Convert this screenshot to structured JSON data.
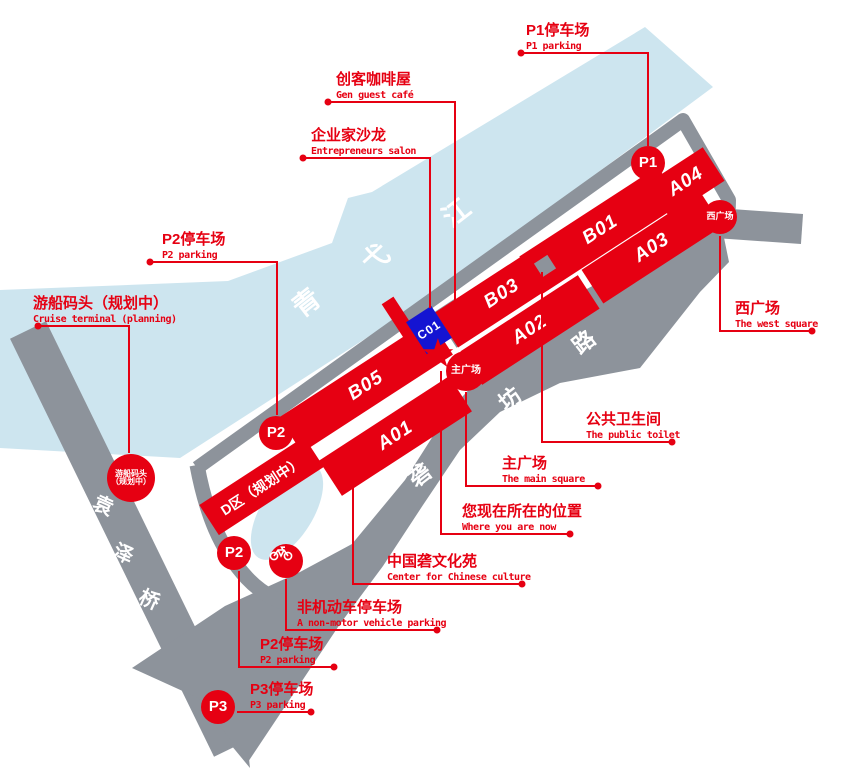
{
  "colors": {
    "accent_red": "#e60012",
    "river_blue": "#cde5ef",
    "road_gray": "#8d939b",
    "c01_blue": "#1414d2"
  },
  "geo_chars": {
    "river": [
      "青",
      "弋",
      "江"
    ],
    "bridge": [
      "袁",
      "泽",
      "桥"
    ],
    "road": [
      "砻",
      "坊",
      "路"
    ]
  },
  "buildings": {
    "b01": "B01",
    "b03": "B03",
    "a01": "A01",
    "a02": "A02",
    "a03": "A03",
    "a04": "A04",
    "b05": "B05",
    "c01": "C01",
    "d_zone": "D区（规划中）"
  },
  "markers": {
    "p1": "P1",
    "p2": "P2",
    "p3": "P3",
    "west_square": "西广场",
    "main_square": "主广场",
    "cruise_line1": "游船码头",
    "cruise_line2": "（规划中）",
    "star": "★"
  },
  "labels": {
    "p1_parking": {
      "zh": "P1停车场",
      "en": "P1 parking"
    },
    "maker_cafe": {
      "zh": "创客咖啡屋",
      "en": "Gen guest café"
    },
    "salon": {
      "zh": "企业家沙龙",
      "en": "Entrepreneurs salon"
    },
    "p2_parking_upper": {
      "zh": "P2停车场",
      "en": "P2 parking"
    },
    "cruise_terminal": {
      "zh": "游船码头（规划中）",
      "en": "Cruise terminal (planning)"
    },
    "west_square": {
      "zh": "西广场",
      "en": "The west square"
    },
    "public_toilet": {
      "zh": "公共卫生间",
      "en": "The public toilet"
    },
    "main_square": {
      "zh": "主广场",
      "en": "The main square"
    },
    "you_are_here": {
      "zh": "您现在所在的位置",
      "en": "Where you are now"
    },
    "culture_center": {
      "zh": "中国砻文化苑",
      "en": "Center for Chinese culture"
    },
    "nonmotor_parking": {
      "zh": "非机动车停车场",
      "en": "A non-motor vehicle parking"
    },
    "p2_parking_lower": {
      "zh": "P2停车场",
      "en": "P2 parking"
    },
    "p3_parking": {
      "zh": "P3停车场",
      "en": "P3 parking"
    }
  }
}
